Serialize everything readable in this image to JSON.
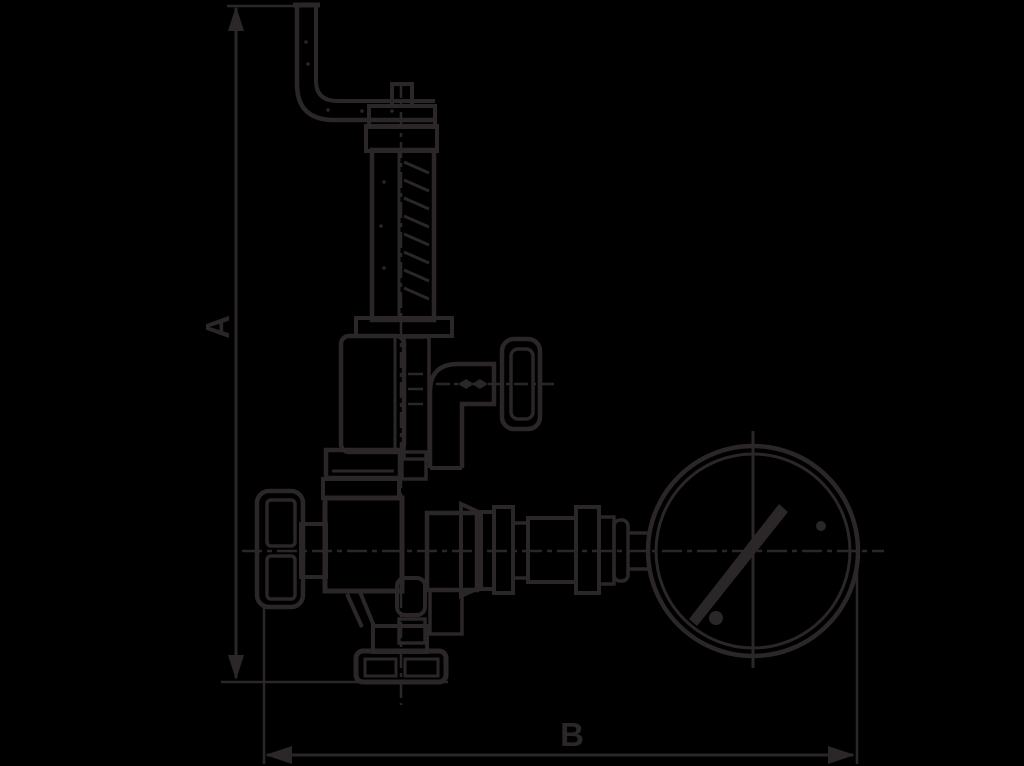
{
  "page": {
    "background": "#000000",
    "ink": "#2b2627"
  },
  "drawing": {
    "type": "technical-dimensional-drawing",
    "subject": "Safety relief valve with lifting lever, handwheels and pressure gauge, side elevation",
    "labels": {
      "a": "A",
      "b": "B"
    }
  }
}
